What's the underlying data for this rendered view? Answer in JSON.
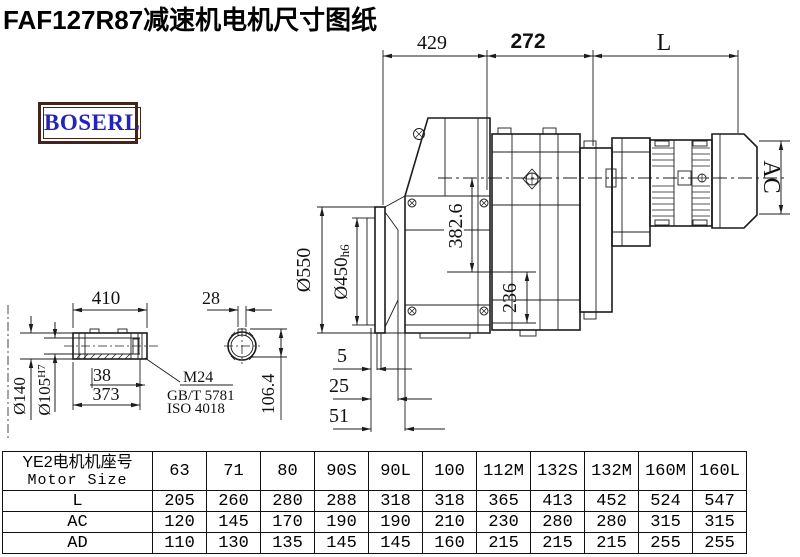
{
  "title": "FAF127R87减速机电机尺寸图纸",
  "logo": {
    "text": "BOSERL"
  },
  "colors": {
    "logo_text": "#2323bb",
    "logo_border": "#45241c",
    "drawing_line": "#1c1c1c"
  },
  "dims": {
    "top_429": "429",
    "top_272": "272",
    "top_L": "L",
    "flange_od": "Ø550",
    "flange_spigot": "Ø450",
    "flange_spigot_tol": "h6",
    "center_height": "382.6",
    "foot": "236",
    "offset_5": "5",
    "offset_25": "25",
    "offset_51": "51",
    "ac": "AC",
    "shaft_len": "410",
    "shaft_od": "Ø140",
    "bore_d": "Ø105",
    "bore_tol": "H7",
    "d38": "38",
    "d373": "373",
    "leader1": "M24",
    "leader2": "GB/T 5781",
    "leader3": "ISO 4018",
    "key_w": "28",
    "key_h": "106.4"
  },
  "table": {
    "header_cn": "YE2电机机座号",
    "header_en": "Motor Size",
    "sizes": [
      "63",
      "71",
      "80",
      "90S",
      "90L",
      "100",
      "112M",
      "132S",
      "132M",
      "160M",
      "160L"
    ],
    "rows": [
      {
        "label": "L",
        "values": [
          "205",
          "260",
          "280",
          "288",
          "318",
          "318",
          "365",
          "413",
          "452",
          "524",
          "547"
        ]
      },
      {
        "label": "AC",
        "values": [
          "120",
          "145",
          "170",
          "190",
          "190",
          "210",
          "230",
          "280",
          "280",
          "315",
          "315"
        ]
      },
      {
        "label": "AD",
        "values": [
          "110",
          "130",
          "135",
          "145",
          "145",
          "160",
          "215",
          "215",
          "215",
          "255",
          "255"
        ]
      }
    ]
  }
}
